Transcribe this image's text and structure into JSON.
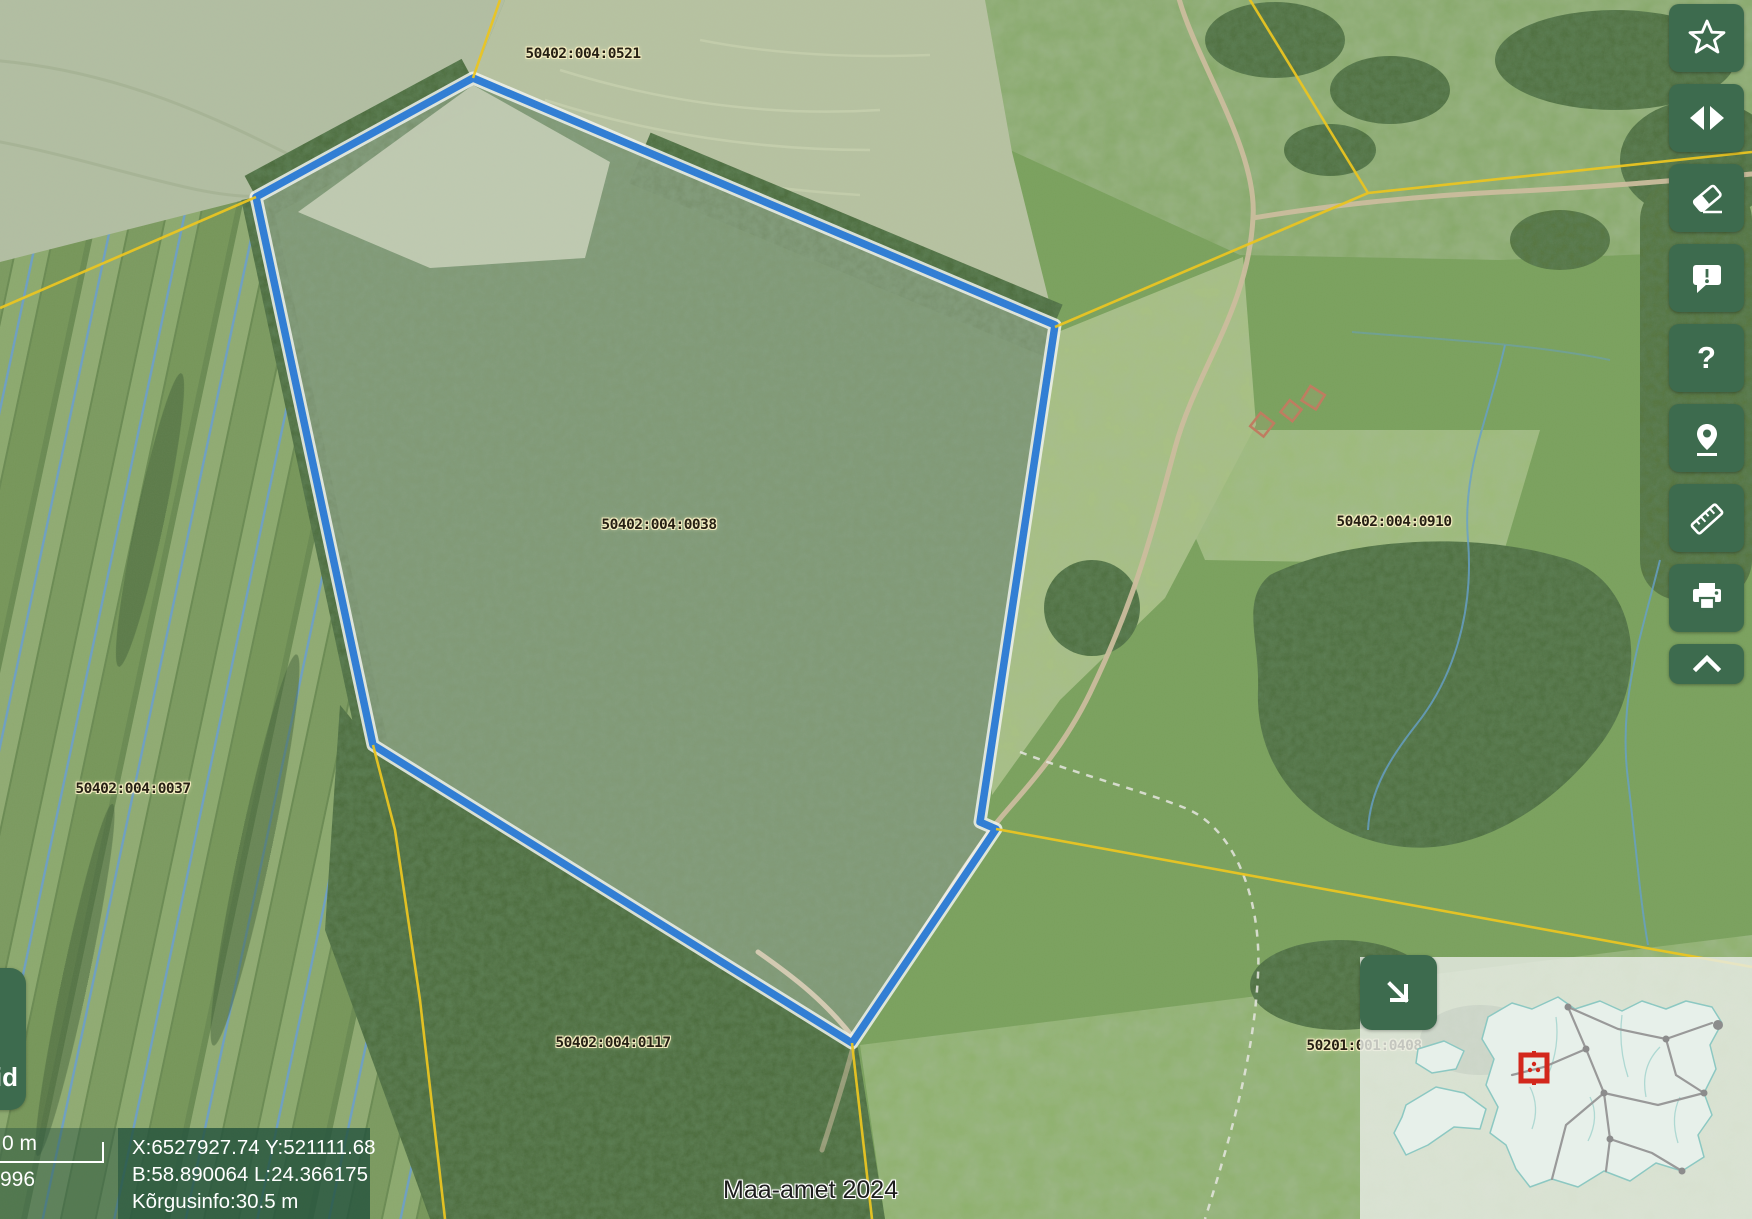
{
  "app": {
    "attribution": "Maa-amet 2024"
  },
  "parcel_labels": [
    {
      "id": "50402:004:0521"
    },
    {
      "id": "50402:004:0038"
    },
    {
      "id": "50402:004:0910"
    },
    {
      "id": "50402:004:0037"
    },
    {
      "id": "50402:004:0117"
    },
    {
      "id": "50201:001:0408"
    }
  ],
  "toolbar": {
    "help_glyph": "?",
    "buttons": [
      "favorites-star",
      "compare-swipe",
      "clear-map",
      "feedback",
      "help",
      "locate",
      "measure",
      "print",
      "collapse-toolbar"
    ]
  },
  "side_tab": {
    "label": "id"
  },
  "scalebar": {
    "top_label": "0 m",
    "bottom_label": "996"
  },
  "info_box": {
    "line1": "X:6527927.74 Y:521111.68",
    "line2": "B:58.890064 L:24.366175",
    "line3": "Kõrgusinfo:30.5 m"
  },
  "overview": {
    "map_name": "estonia-overview"
  },
  "colors": {
    "toolbar_green": "#3d6b4e",
    "highlight_blue": "#2d7cd6",
    "cadastral_yellow": "#ecc51c",
    "marker_red": "#d3271c",
    "label_halo": "#f3ecc0"
  }
}
